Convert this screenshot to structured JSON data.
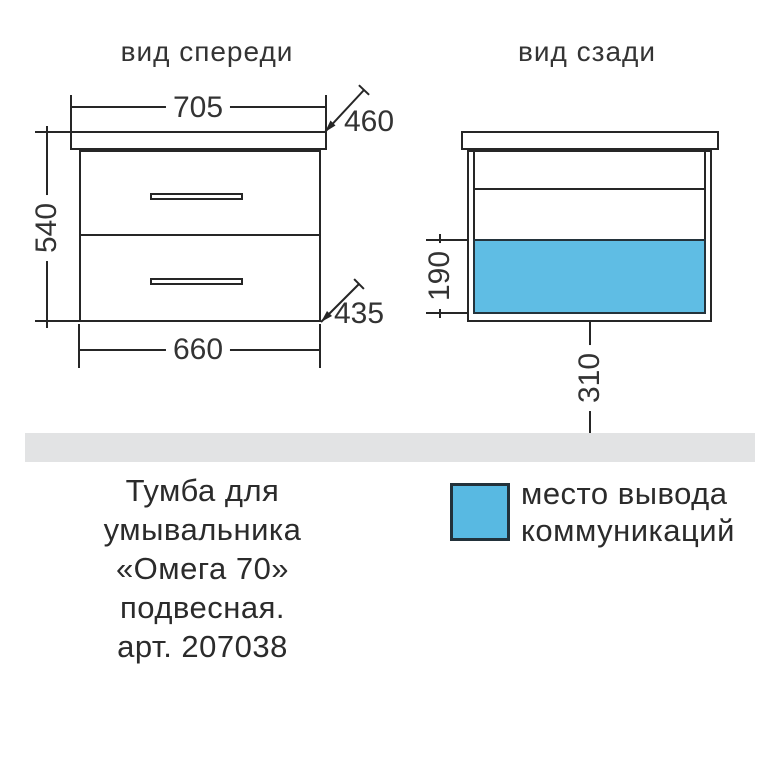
{
  "front_view": {
    "title": "вид спереди",
    "dims": {
      "top_width": "705",
      "top_depth": "460",
      "height": "540",
      "bottom_width": "660",
      "bottom_depth": "435"
    }
  },
  "rear_view": {
    "title": "вид сзади",
    "dims": {
      "comm_zone_height": "190",
      "floor_offset": "310"
    }
  },
  "legend": {
    "line1": "место вывода",
    "line2": "коммуникаций",
    "swatch_color": "#58b9e2"
  },
  "caption": {
    "lines": [
      "Тумба для",
      "умывальника",
      "«Омега 70»",
      "подвесная.",
      "арт. 207038"
    ]
  },
  "colors": {
    "line": "#262626",
    "accent_blue": "#5fbde4",
    "floor_gray": "#e2e3e4"
  }
}
